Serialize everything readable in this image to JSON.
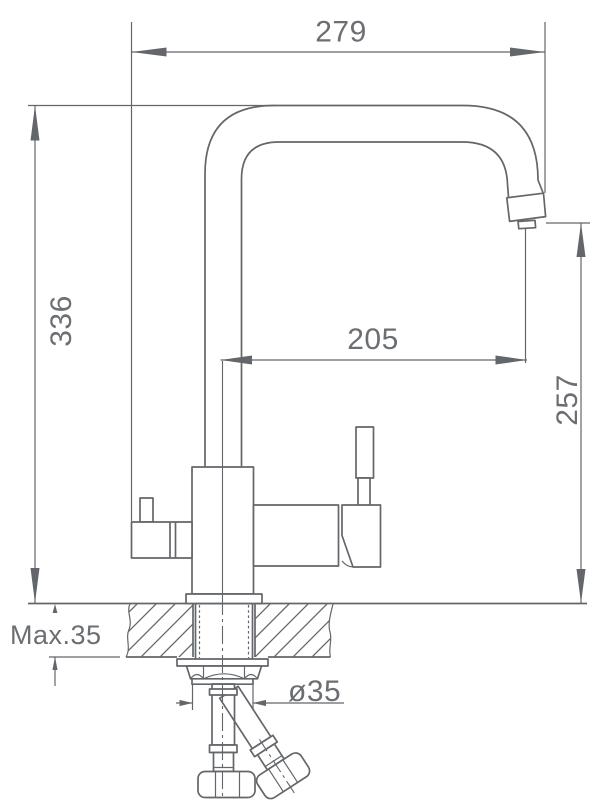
{
  "page": {
    "background": "#ffffff"
  },
  "colors": {
    "line": "#63666a",
    "text": "#6b6e72"
  },
  "drawing": {
    "title": "kitchen-faucet-installation-dimension-drawing",
    "dimensions": {
      "spout_width": "279",
      "overall_height": "336",
      "spout_reach": "205",
      "outlet_height": "257",
      "max_counter_thickness": "Max.35",
      "hole_diameter": "ø35"
    }
  }
}
